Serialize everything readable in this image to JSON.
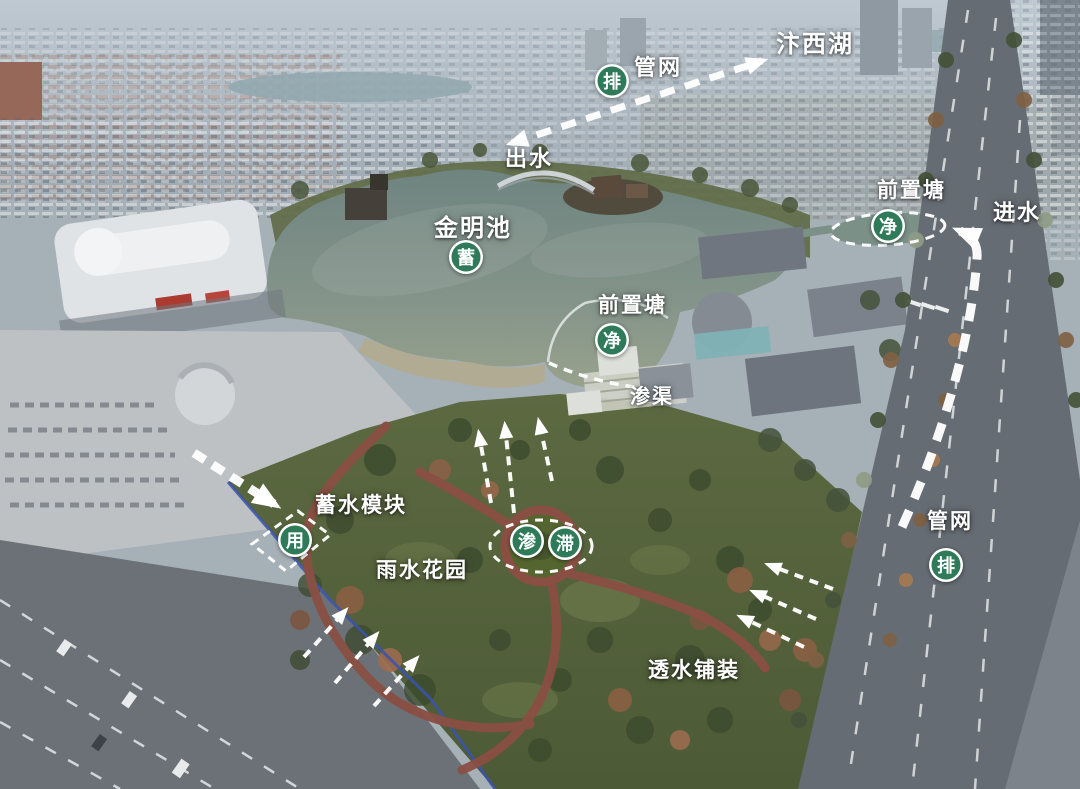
{
  "colors": {
    "badge_green": "#2e7a59",
    "annotation_white": "#ffffff",
    "lake_water": "#7b8f86",
    "park_green": "#55633e"
  },
  "annotations": {
    "labels": {
      "dest_lake": "汴西湖",
      "pipe_network_top": "管网",
      "outflow": "出水",
      "main_lake": "金明池",
      "forebay_right": "前置塘",
      "inflow": "进水",
      "forebay_mid": "前置塘",
      "infiltration_channel": "渗渠",
      "storage_module": "蓄水模块",
      "rain_garden": "雨水花园",
      "permeable_paving": "透水铺装",
      "pipe_network_right": "管网"
    },
    "badges": {
      "discharge_top": "排",
      "store": "蓄",
      "purify_right": "净",
      "purify_mid": "净",
      "use": "用",
      "infiltrate": "渗",
      "detain": "滞",
      "discharge_right": "排"
    }
  }
}
